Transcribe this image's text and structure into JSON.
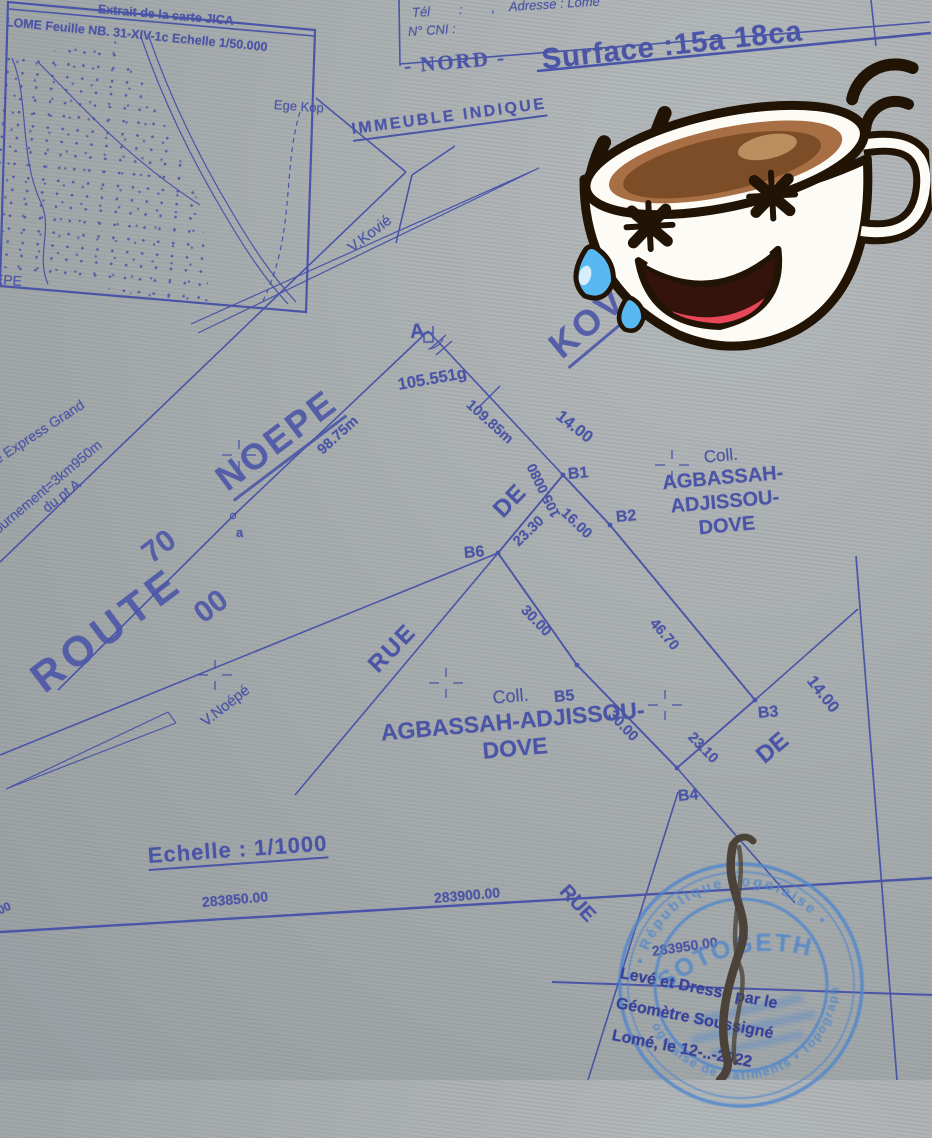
{
  "inset_map": {
    "header_line1": "Extrait de la carte JICA",
    "header_line2": "LOME Feuille NB. 31-XIV-1c Echelle 1/50.000",
    "label_left_partial": "EPE",
    "label_village": "Ege Kop"
  },
  "header": {
    "tel_row": "Tél        :        ,    Adresse : Lomé",
    "cni_row": "N° CNI :",
    "nord": "- NORD -",
    "surface": "Surface :15a 18ca"
  },
  "annotations": {
    "immeuble": "IMMEUBLE INDIQUE",
    "v_kovie": "V.Kovié",
    "v_noepe": "V.Noépé",
    "margin_line1": "ie Express Grand",
    "margin_line2": "tournement=3km950m",
    "margin_line3": "du pt A"
  },
  "roads": {
    "route": "ROUTE",
    "num_70": "70",
    "num_00": "00",
    "noepe": "NOEPE",
    "kovie": "KOVIE",
    "rue_mid": "RUE",
    "de_mid": "DE",
    "rue_bottom": "RUE",
    "de_right": "DE",
    "width_top": "14.00",
    "width_right": "14.00"
  },
  "survey": {
    "point_a": "A",
    "point_a_minor": "a",
    "angle_a": "105.551g",
    "dist_axis": "98.75m",
    "dist_traverse": "109.85m",
    "bearing": "105.0080",
    "b1": "B1",
    "b2": "B2",
    "b3": "B3",
    "b4": "B4",
    "b5": "B5",
    "b6": "B6",
    "d_b1b2": "16.00",
    "d_b2b3": "46.70",
    "d_b3b4": "23.10",
    "d_b4b5": "30.00",
    "d_b5b6": "30.00",
    "d_b6b1": "23.30"
  },
  "owners": {
    "right_line1": "Coll.",
    "right_line2": "AGBASSAH-",
    "right_line3": "ADJISSOU-",
    "right_line4": "DOVE",
    "bottom_line1": "Coll.",
    "bottom_line2": "AGBASSAH-ADJISSOU-",
    "bottom_line3": "DOVE"
  },
  "footer": {
    "echelle": "Echelle : 1/1000",
    "coord_1": "283850.00",
    "coord_2": "283900.00",
    "coord_3": "283950.00",
    "coord_left_partial": "00"
  },
  "stamp": {
    "arc_top": "• République Togolaise •",
    "arc_bottom": "Togolaise de Bâtiments • Topographe",
    "name": "SOTOGETH",
    "attest_line1": "Levé et Dressé par le",
    "attest_line2": "Géomètre Soussigné",
    "attest_line3": "Lomé, le 12-..-2022"
  },
  "colors": {
    "paper": "#a7acae",
    "ink": "#4a55a8",
    "stamp_blue": "#4f86cc",
    "signature": "#4b4339"
  }
}
